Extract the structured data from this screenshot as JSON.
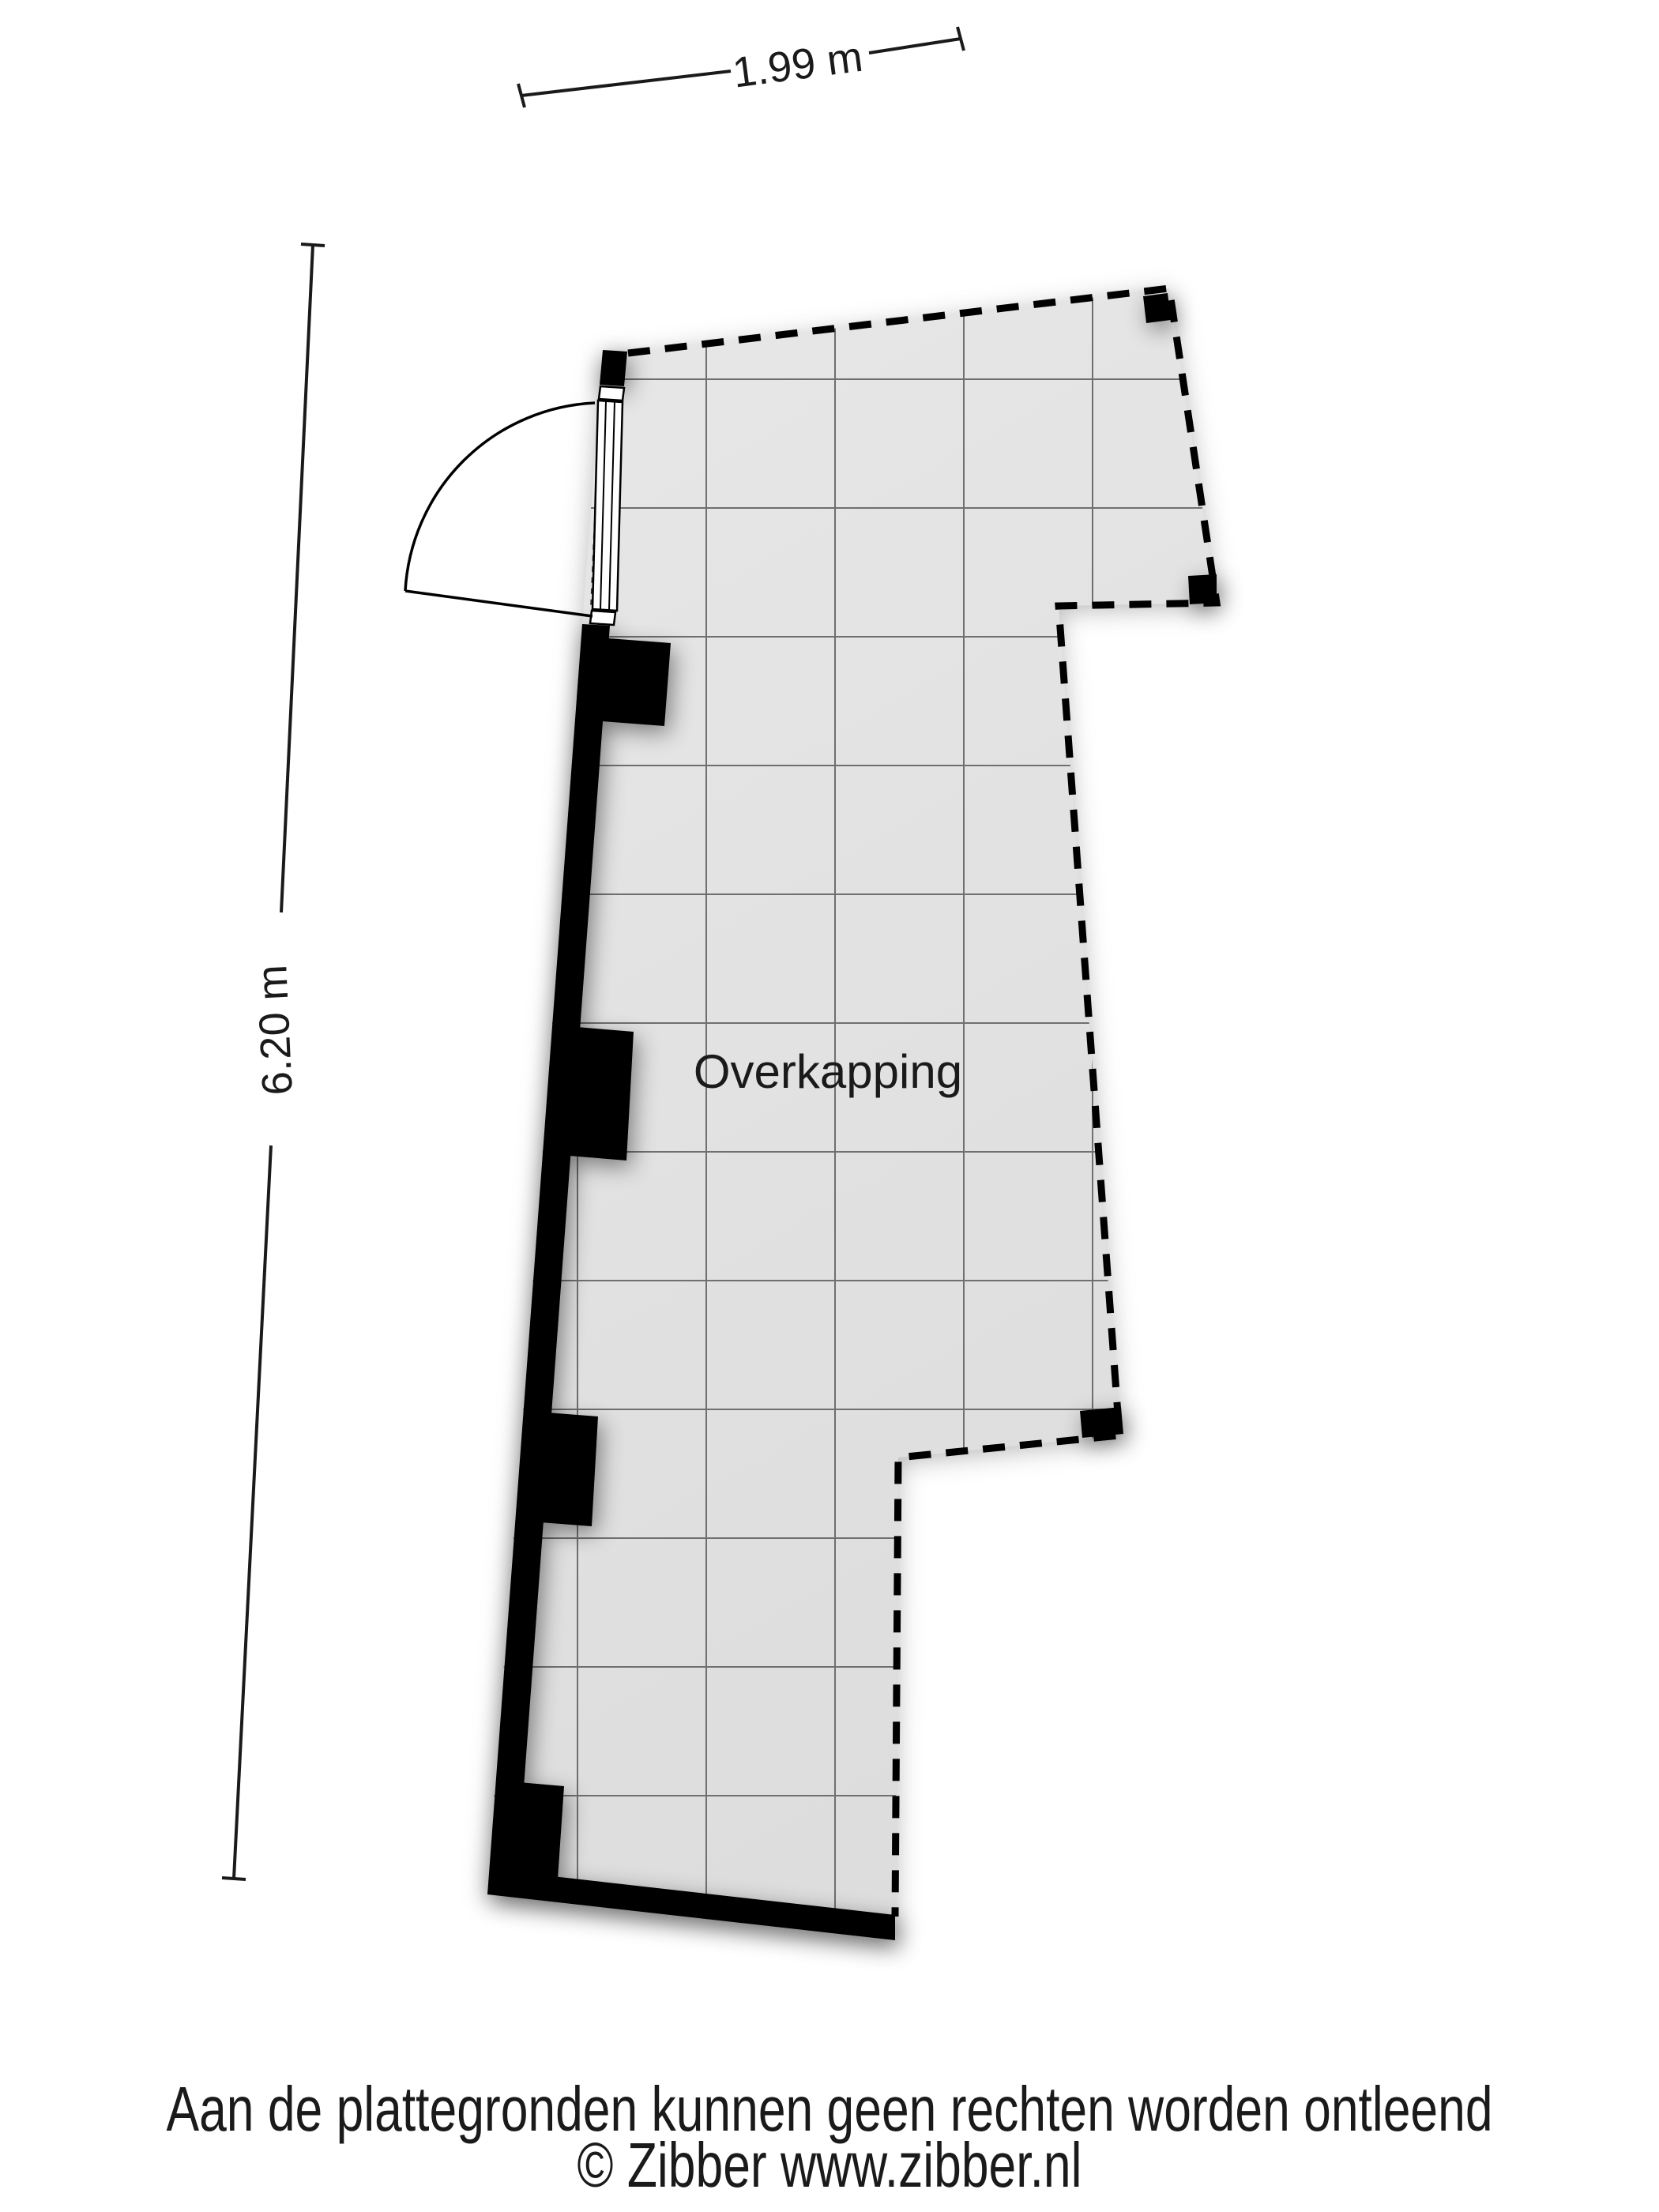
{
  "plan": {
    "room_label": "Overkapping",
    "dim_top_label": "1.99 m",
    "dim_left_label": "6.20 m",
    "colors": {
      "floor": "#e2e2e2",
      "wall": "#000000",
      "grid": "#6f6f6f",
      "boundary": "#000000",
      "text": "#1a1a1a"
    }
  },
  "footer": {
    "disclaimer": "Aan de plattegronden kunnen geen rechten worden ontleend",
    "copyright": "© Zibber www.zibber.nl"
  }
}
